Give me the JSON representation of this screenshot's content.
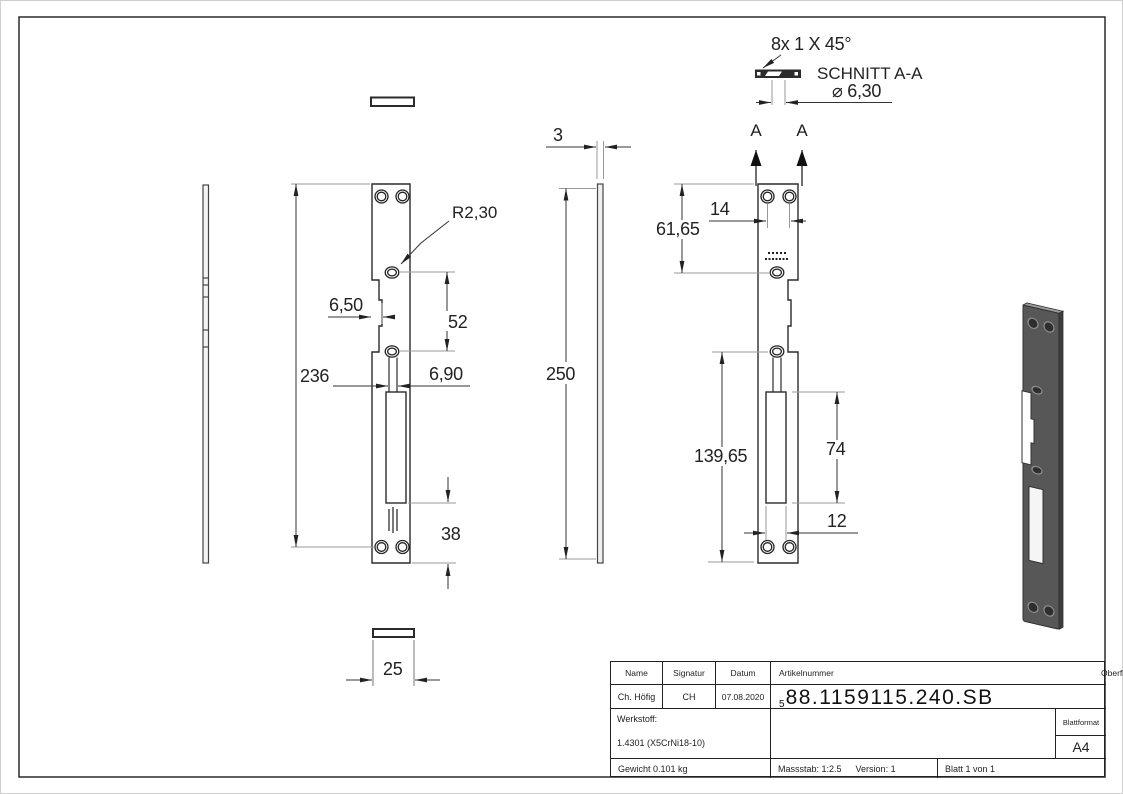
{
  "section_detail": {
    "chamfer_note": "8x 1 X 45°",
    "title": "SCHNITT A-A",
    "hole_diameter": "⌀ 6,30",
    "marker": "A"
  },
  "dimensions": {
    "front": {
      "overall_height": "236",
      "notch_depth": "6,50",
      "notch_height": "52",
      "channel_width": "6,90",
      "bottom_offset": "38",
      "plate_width": "25",
      "corner_radius": "R2,30"
    },
    "side": {
      "thickness": "3",
      "overall_height": "250"
    },
    "back": {
      "hole_spacing": "14",
      "top_to_notch": "61,65",
      "notch_to_bottom": "139,65",
      "slot_height": "74",
      "slot_width": "12"
    }
  },
  "titleblock": {
    "name_label": "Name",
    "signatur_label": "Signatur",
    "datum_label": "Datum",
    "name_value": "Ch. Höfig",
    "signatur_value": "CH",
    "datum_value": "07.08.2020",
    "artikelnummer_label": "Artikelnummer",
    "artikelnummer_prefix": "5",
    "artikelnummer_value": "88.1159115.240.SB",
    "oberflaeche_label": "Oberfläche:",
    "oberflaeche_value": "Geschliffen Korn 240",
    "werkstoff_label": "Werkstoff:",
    "werkstoff_value": "1.4301 (X5CrNi18-10)",
    "blattformat_label": "Blattformat",
    "blattformat_value": "A4",
    "gewicht_value": "Gewicht 0.101 kg",
    "massstab_value": "Massstab: 1:2.5",
    "version_value": "Version: 1",
    "blatt_value": "Blatt 1 von 1"
  }
}
